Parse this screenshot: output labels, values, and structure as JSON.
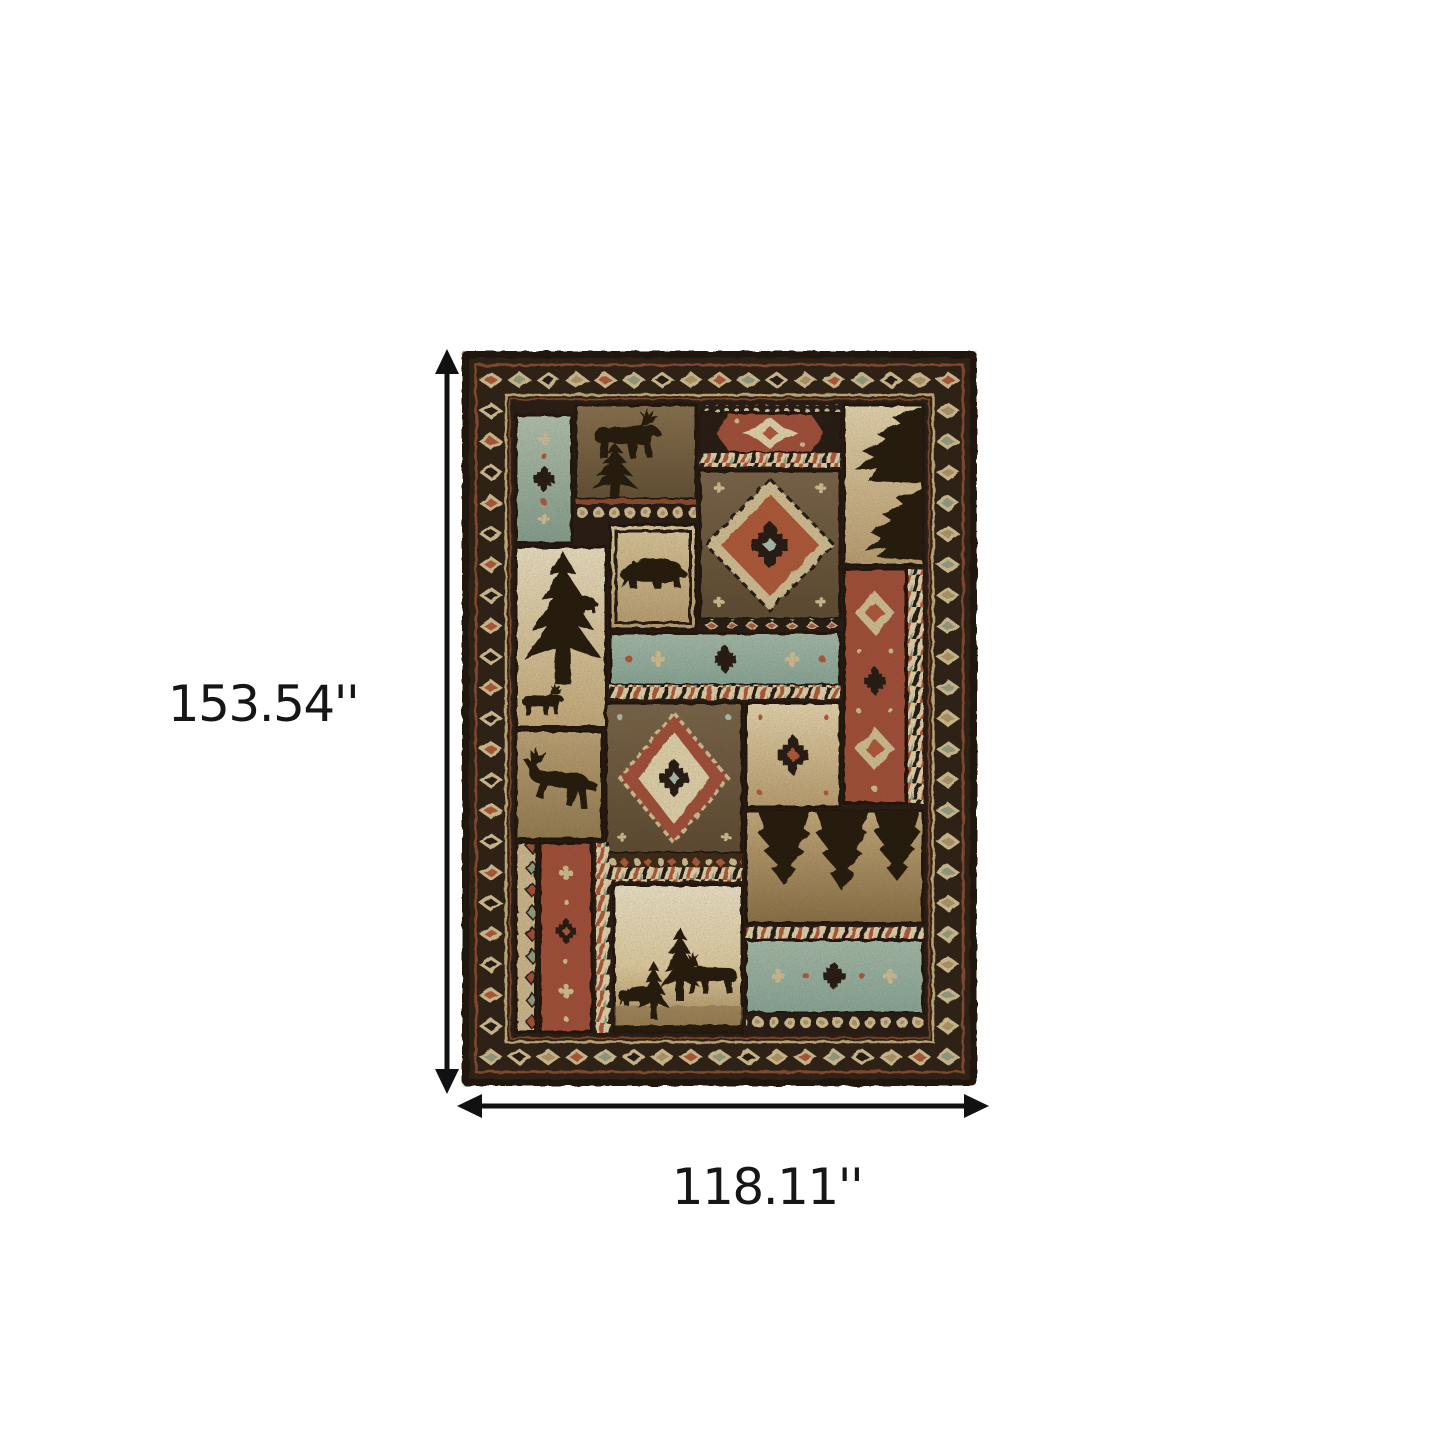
{
  "page": {
    "background": "#ffffff"
  },
  "figure": {
    "type": "product-dimension-diagram",
    "subject": "Rustic southwestern lodge patchwork area rug, portrait orientation, centered on white background",
    "dimensions": {
      "height_label": "153.54''",
      "width_label": "118.11''"
    },
    "arrow_color": "#111111",
    "label_color": "#161616"
  },
  "rug": {
    "style": "southwestern cabin / lodge patchwork",
    "border": "near-black border with cream diamond-chain band and thin rust lines",
    "motifs": [
      "moose silhouette",
      "black bear silhouettes",
      "pine tree silhouettes",
      "leaping deer silhouette",
      "aztec zigzag diamond medallions",
      "teal geometric bands",
      "rust panels with cream diamonds",
      "rope twist bands",
      "bead bands",
      "hanging pine boughs",
      "forest scene with moose and bear"
    ],
    "palette": {
      "bg": "#ffffff",
      "arrow": "#111111",
      "label": "#161616",
      "edge": "#1b130c",
      "borderField": "#2b1e12",
      "rustLine": "#8c4a2e",
      "beigeLine": "#c9b27f",
      "diamondCream": "#d7c498",
      "cream": "#e8d9b2",
      "beige": "#d3bd92",
      "tan": "#b49a6c",
      "rust": "#a5503a",
      "rustBright": "#b3593a",
      "sage": "#97a286",
      "teal": "#9eb5a9",
      "tealLight": "#aec4b4",
      "brown": "#6e5a3e",
      "dark": "#241a10",
      "silhouette": "#221708",
      "gap": "#261a0f"
    }
  }
}
